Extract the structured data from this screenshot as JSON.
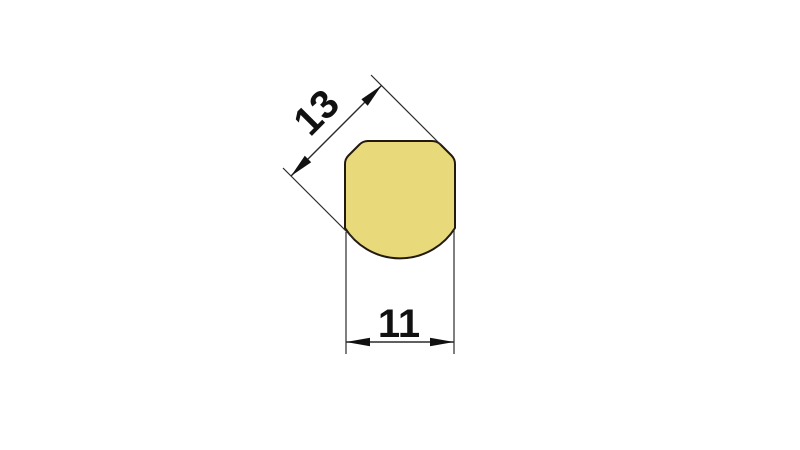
{
  "page": {
    "background_color": "#ffffff",
    "kind": "technical-dimension-drawing"
  },
  "drawing": {
    "profile": {
      "name": "rounded-square-profile-with-chamfered-top-and-round-bottom",
      "fill_color": "#e8d97a",
      "outline_color": "#221a0e"
    },
    "dimensions": [
      {
        "value": "13",
        "orientation": "diagonal-45deg",
        "measures": "diagonal width across chamfer to bottom radius"
      },
      {
        "value": "11",
        "orientation": "horizontal",
        "measures": "overall width"
      }
    ],
    "line_color": "#2b2b2b",
    "text_color": "#111111"
  }
}
